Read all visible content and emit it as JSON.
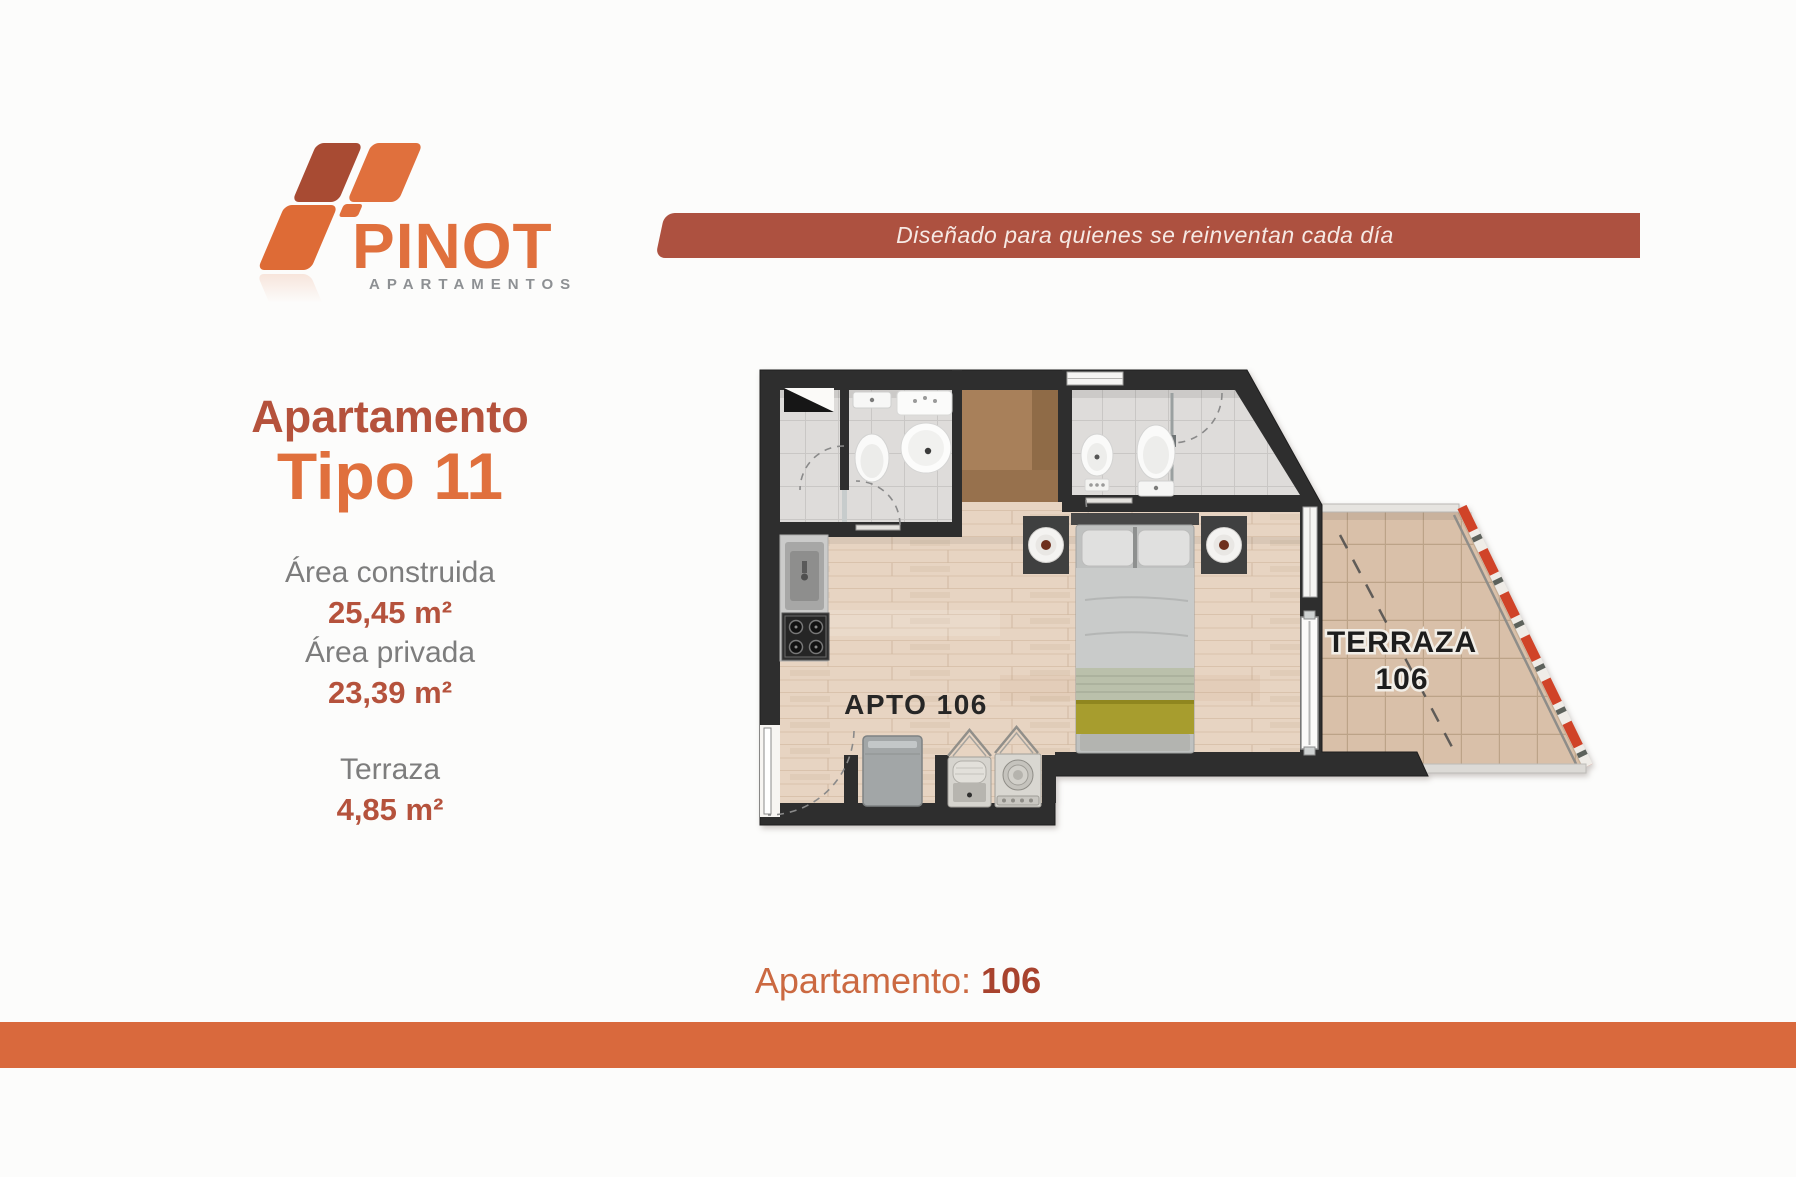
{
  "colors": {
    "brand_orange": "#e0703d",
    "brand_dark_red": "#a84b33",
    "heading_red": "#b5523c",
    "muted_gray": "#7d7d7d",
    "banner_bg": "#ad5140",
    "bottom_bar": "#d9693d",
    "wood_floor": "#e7d4c2",
    "terrace_tile": "#d9c0a9",
    "wall": "#2e2e2e",
    "railing_red": "#d04328"
  },
  "logo": {
    "name": "PINOT",
    "subtitle": "APARTAMENTOS"
  },
  "banner": {
    "text": "Diseñado para quienes se reinventan cada día"
  },
  "info": {
    "title_line1": "Apartamento",
    "title_line2": "Tipo 11",
    "area_built_label": "Área construida",
    "area_built_value": "25,45 m²",
    "area_private_label": "Área privada",
    "area_private_value": "23,39 m²",
    "terrace_label": "Terraza",
    "terrace_value": "4,85 m²"
  },
  "floorplan": {
    "apartment_label": "APTO 106",
    "terrace_label_line1": "TERRAZA",
    "terrace_label_line2": "106"
  },
  "footer": {
    "label": "Apartamento:",
    "value": "106"
  }
}
